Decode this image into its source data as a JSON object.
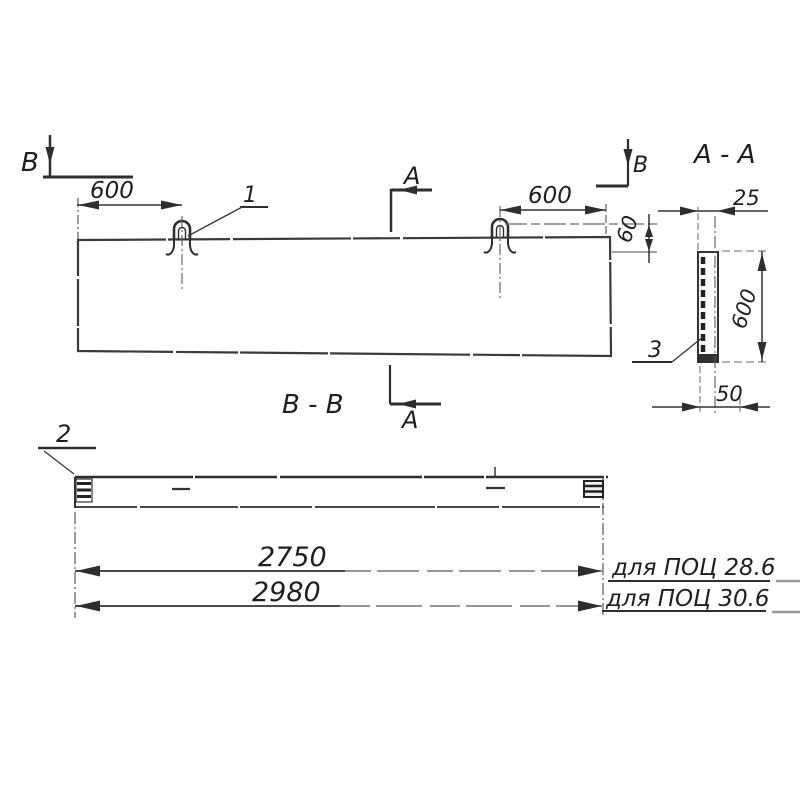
{
  "drawing": {
    "ink_color": "#343434",
    "faded_color": "#8a8a8a",
    "labels": {
      "cut_b_left": "В",
      "cut_b_right": "В",
      "cut_a_top": "А",
      "cut_a_bottom": "А",
      "item_1": "1",
      "item_2": "2",
      "item_3": "3",
      "section_aa_title": "А - А",
      "section_bb_title": "В - В"
    },
    "dimensions": {
      "loop_offset_left": "600",
      "loop_offset_right": "600",
      "loop_height": "60",
      "slab_thickness": "25",
      "section_height": "600",
      "base_width": "50",
      "length_variant_1": "2750",
      "length_variant_2": "2980"
    },
    "notes": {
      "variant_1": "для ПОЦ 28.6",
      "variant_2": "для ПОЦ 30.6"
    }
  }
}
